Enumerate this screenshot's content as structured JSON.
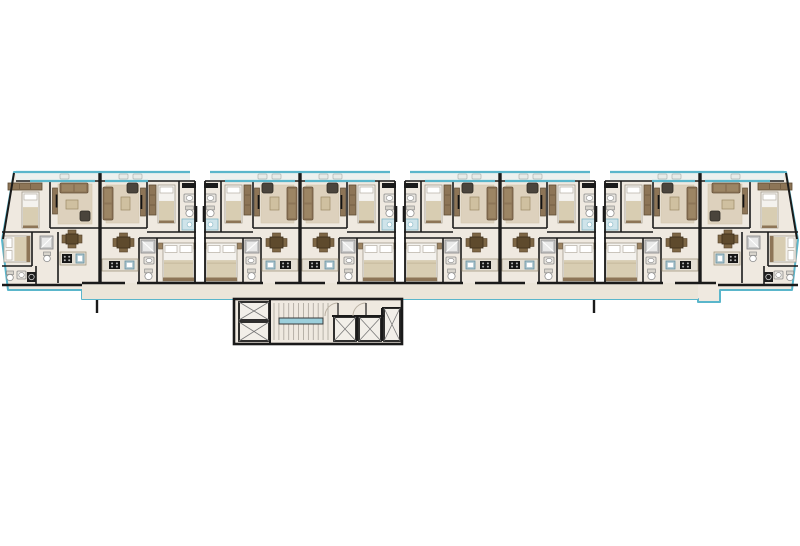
{
  "plan": {
    "kind": "typical-floor-plan",
    "unit_count": 8,
    "elevator_count": 2,
    "shaft_count": 3,
    "stairwell_count": 1
  },
  "palette": {
    "outline": "#5ab6cb",
    "wall": "#1a1a1a",
    "floor": "#efe9e0",
    "corridor": "#ebe5d9",
    "balcony": "#edf1ef",
    "rug": "#cdbb9b",
    "wood": "#8d7557",
    "wood_dark": "#5d4a33",
    "wood_deep": "#5e4a2d",
    "chair_wood": "#7d6645",
    "dark_seat": "#4a443c",
    "bed": "#f4f2ee",
    "bed_stroke": "#a29a8d",
    "pillow": "#ffffff",
    "blanket": "#d8cdb2",
    "counter": "#e4dfd4",
    "counter_edge": "#a3987f",
    "steel_sink": "#a9c3cd",
    "steel_edge": "#6a93a2",
    "stove": "#161616",
    "fixture_fill": "#e9e6e0",
    "fixture_edge": "#8c8c8c",
    "shower_light": "#cfe4ea",
    "shower_edge": "#7fb3c2",
    "shower_gray": "#c7c7c7",
    "gray_edge": "#8f8f8f",
    "stair_tread": "#a9a49b",
    "rail": "#9ccfdb",
    "door_arc": "#b9b0a2",
    "cell": "#f2efe9",
    "xline": "#787878",
    "balcony_chair": "#e7ebe8",
    "balcony_chair_edge": "#aeb6b2",
    "white": "#ffffff"
  },
  "geometry": {
    "canvas": {
      "w": 800,
      "h": 546
    },
    "silhouette": [
      [
        14,
        172
      ],
      [
        786,
        172
      ],
      [
        798,
        240
      ],
      [
        792,
        290
      ],
      [
        720,
        290
      ],
      [
        720,
        302
      ],
      [
        698,
        302
      ],
      [
        698,
        299
      ],
      [
        402,
        299
      ],
      [
        402,
        344
      ],
      [
        234,
        344
      ],
      [
        234,
        299
      ],
      [
        82,
        299
      ],
      [
        82,
        290
      ],
      [
        8,
        290
      ],
      [
        2,
        240
      ]
    ],
    "balconies": [
      [
        16,
        190
      ],
      [
        210,
        390
      ],
      [
        410,
        590
      ],
      [
        610,
        784
      ]
    ],
    "facade_y": 172,
    "balcony_floor_y": 181,
    "windows": [
      [
        30,
        95
      ],
      [
        105,
        148
      ],
      [
        225,
        295
      ],
      [
        305,
        375
      ],
      [
        425,
        495
      ],
      [
        505,
        575
      ],
      [
        652,
        695
      ],
      [
        705,
        770
      ]
    ],
    "dividers": [
      100,
      300,
      500,
      700
    ],
    "junctions": [
      200,
      400,
      600
    ],
    "corridor": {
      "x": 82,
      "y": 283,
      "w": 616,
      "h": 16
    },
    "bottom_wall_y": 283,
    "bottom_wall_segments": [
      [
        82,
        125
      ],
      [
        137,
        263
      ],
      [
        275,
        325
      ],
      [
        337,
        463
      ],
      [
        475,
        525
      ],
      [
        537,
        663
      ],
      [
        675,
        716
      ]
    ],
    "stubs": [
      [
        97,
        300,
        97,
        313
      ],
      [
        594,
        300,
        594,
        313
      ]
    ],
    "slant_walls": [
      [
        14,
        173,
        3,
        239
      ],
      [
        786,
        173,
        797,
        239
      ]
    ],
    "units": [
      {
        "name": "apartment-unit-1",
        "template": "end",
        "origin": 0,
        "mirror": false,
        "axis": 0
      },
      {
        "name": "apartment-unit-2",
        "template": "std",
        "origin": 0,
        "mirror": true,
        "axis": 100
      },
      {
        "name": "apartment-unit-3",
        "template": "std",
        "origin": 200,
        "mirror": false,
        "axis": 0
      },
      {
        "name": "apartment-unit-4",
        "template": "std",
        "origin": 200,
        "mirror": true,
        "axis": 300
      },
      {
        "name": "apartment-unit-5",
        "template": "std",
        "origin": 400,
        "mirror": false,
        "axis": 0
      },
      {
        "name": "apartment-unit-6",
        "template": "std",
        "origin": 400,
        "mirror": true,
        "axis": 500
      },
      {
        "name": "apartment-unit-7",
        "template": "std",
        "origin": 600,
        "mirror": false,
        "axis": 0
      },
      {
        "name": "apartment-unit-8",
        "template": "end",
        "origin": 0,
        "mirror": true,
        "axis": 400
      }
    ],
    "templates": {
      "std": {
        "walls": [
          [
            21,
            181,
            21,
            232
          ],
          [
            53,
            181,
            53,
            228
          ],
          [
            0,
            232,
            53,
            232
          ],
          [
            53,
            228,
            100,
            228
          ],
          [
            0,
            238,
            61,
            238
          ],
          [
            43,
            238,
            43,
            283
          ],
          [
            61,
            238,
            61,
            283
          ]
        ],
        "thick_walls": [],
        "items": [
          {
            "t": "duct",
            "n": "vent-duct-icon",
            "x": 4,
            "y": 183,
            "w": 14,
            "h": 5
          },
          {
            "t": "sink",
            "n": "sink-icon",
            "x": 5,
            "y": 194,
            "w": 11,
            "h": 8
          },
          {
            "t": "toilet",
            "n": "toilet-icon",
            "x": 5,
            "y": 206,
            "w": 11,
            "h": 11
          },
          {
            "t": "shower-c",
            "n": "shower-icon",
            "x": 3,
            "y": 219,
            "w": 15,
            "h": 11
          },
          {
            "t": "bed1",
            "n": "single-bed-icon",
            "x": 25,
            "y": 185,
            "w": 17,
            "h": 38
          },
          {
            "t": "wardrobe",
            "n": "wardrobe-icon",
            "x": 44,
            "y": 185,
            "w": 7,
            "h": 30
          },
          {
            "t": "tv",
            "n": "tv-cabinet-icon",
            "x": 54.5,
            "y": 188,
            "w": 5,
            "h": 28
          },
          {
            "t": "rug",
            "n": "rug-icon",
            "x": 61,
            "y": 185,
            "w": 33,
            "h": 38
          },
          {
            "t": "armchair",
            "n": "armchair-icon",
            "x": 62,
            "y": 183,
            "w": 11,
            "h": 10
          },
          {
            "t": "sofa-v",
            "n": "sofa-icon",
            "x": 87,
            "y": 187,
            "w": 10,
            "h": 33
          },
          {
            "t": "ctable",
            "n": "coffee-table-icon",
            "x": 70,
            "y": 197,
            "w": 9,
            "h": 13
          },
          {
            "t": "bed2-v",
            "n": "double-bed-icon",
            "x": 6,
            "y": 243,
            "w": 31,
            "h": 38
          },
          {
            "t": "nstand",
            "n": "nightstand-icon",
            "x": 2,
            "y": 243,
            "w": 4,
            "h": 6
          },
          {
            "t": "nstand",
            "n": "nightstand-icon",
            "x": 37.5,
            "y": 243,
            "w": 4,
            "h": 6
          },
          {
            "t": "shower",
            "n": "shower-icon",
            "x": 45,
            "y": 240,
            "w": 14,
            "h": 13
          },
          {
            "t": "sink",
            "n": "sink-icon",
            "x": 46,
            "y": 257,
            "w": 10,
            "h": 7
          },
          {
            "t": "toilet",
            "n": "toilet-icon",
            "x": 46,
            "y": 269,
            "w": 11,
            "h": 11
          },
          {
            "t": "dtable",
            "n": "dining-table-icon",
            "x": 66,
            "y": 233,
            "w": 21,
            "h": 19
          },
          {
            "t": "counter",
            "n": "kitchen-counter-icon",
            "x": 62,
            "y": 259,
            "w": 36,
            "h": 12
          },
          {
            "t": "ksink",
            "n": "kitchen-sink-icon",
            "x": 66,
            "y": 261,
            "w": 9,
            "h": 8
          },
          {
            "t": "stove",
            "n": "stove-icon",
            "x": 80,
            "y": 261,
            "w": 11,
            "h": 8
          },
          {
            "t": "bchair",
            "n": "balcony-chair-icon",
            "x": 58,
            "y": 174,
            "w": 9,
            "h": 5
          },
          {
            "t": "bchair",
            "n": "balcony-chair-icon",
            "x": 72,
            "y": 174,
            "w": 9,
            "h": 5
          }
        ]
      },
      "end": {
        "walls": [
          [
            50,
            181,
            50,
            228
          ],
          [
            50,
            228,
            100,
            228
          ],
          [
            2,
            232,
            50,
            232
          ],
          [
            32,
            232,
            32,
            266
          ],
          [
            2,
            266,
            32,
            266
          ],
          [
            58,
            232,
            58,
            283
          ],
          [
            36,
            266,
            36,
            285
          ]
        ],
        "thick_walls": [
          [
            2,
            285,
            82,
            285
          ]
        ],
        "items": [
          {
            "t": "wardrobe-h",
            "n": "wardrobe-icon",
            "x": 8,
            "y": 183,
            "w": 34,
            "h": 7
          },
          {
            "t": "bed1",
            "n": "single-bed-icon",
            "x": 22,
            "y": 192,
            "w": 17,
            "h": 36
          },
          {
            "t": "tv",
            "n": "tv-cabinet-icon",
            "x": 52.5,
            "y": 188,
            "w": 5,
            "h": 26
          },
          {
            "t": "rug",
            "n": "rug-icon",
            "x": 58,
            "y": 184,
            "w": 34,
            "h": 40
          },
          {
            "t": "sofa-h",
            "n": "sofa-icon",
            "x": 60,
            "y": 183,
            "w": 28,
            "h": 10
          },
          {
            "t": "ctable",
            "n": "coffee-table-icon",
            "x": 66,
            "y": 200,
            "w": 12,
            "h": 9
          },
          {
            "t": "armchair",
            "n": "armchair-icon",
            "x": 80,
            "y": 211,
            "w": 10,
            "h": 10
          },
          {
            "t": "bed2-h",
            "n": "double-bed-icon",
            "x": 4,
            "y": 236,
            "w": 26,
            "h": 26
          },
          {
            "t": "dtable",
            "n": "dining-table-icon",
            "x": 62,
            "y": 230,
            "w": 20,
            "h": 18
          },
          {
            "t": "counter",
            "n": "kitchen-counter-icon",
            "x": 60,
            "y": 252,
            "w": 26,
            "h": 13
          },
          {
            "t": "stove",
            "n": "stove-icon",
            "x": 62,
            "y": 254,
            "w": 10,
            "h": 9
          },
          {
            "t": "ksink",
            "n": "kitchen-sink-icon",
            "x": 76,
            "y": 254,
            "w": 8,
            "h": 9
          },
          {
            "t": "shower",
            "n": "shower-icon",
            "x": 40,
            "y": 236,
            "w": 13,
            "h": 13
          },
          {
            "t": "toilet",
            "n": "toilet-icon",
            "x": 42,
            "y": 252,
            "w": 10,
            "h": 10
          },
          {
            "t": "toilet",
            "n": "toilet-icon",
            "x": 5,
            "y": 271,
            "w": 10,
            "h": 10
          },
          {
            "t": "sink",
            "n": "sink-icon",
            "x": 17,
            "y": 271,
            "w": 9,
            "h": 8
          },
          {
            "t": "wash",
            "n": "washer-icon",
            "x": 27,
            "y": 272,
            "w": 9,
            "h": 10
          },
          {
            "t": "bchair",
            "n": "balcony-chair-icon",
            "x": 60,
            "y": 174,
            "w": 9,
            "h": 5
          }
        ]
      }
    },
    "core": {
      "outline": [
        234,
        299,
        168,
        45
      ],
      "cells": [
        {
          "n": "shaft-icon",
          "x": 239,
          "y": 302,
          "w": 30,
          "h": 18
        },
        {
          "n": "shaft-icon",
          "x": 239,
          "y": 322,
          "w": 30,
          "h": 19
        },
        {
          "n": "elevator-icon",
          "x": 334,
          "y": 317,
          "w": 22,
          "h": 24
        },
        {
          "n": "elevator-icon",
          "x": 359,
          "y": 317,
          "w": 22,
          "h": 24
        },
        {
          "n": "shaft-icon",
          "x": 384,
          "y": 308,
          "w": 16,
          "h": 33
        }
      ],
      "stairs": {
        "x": 272,
        "x2": 330,
        "y": 303,
        "y2": 340,
        "rail": [
          279,
          318,
          44,
          6
        ],
        "treads": 11
      },
      "walls": [
        [
          270,
          299,
          270,
          344
        ],
        [
          332,
          316,
          400,
          316
        ],
        [
          357,
          317,
          357,
          341
        ],
        [
          382,
          308,
          382,
          341
        ],
        [
          382,
          308,
          400,
          308
        ]
      ],
      "arcs": [
        [
          338,
          316,
          13
        ],
        [
          366,
          316,
          13
        ]
      ]
    }
  }
}
